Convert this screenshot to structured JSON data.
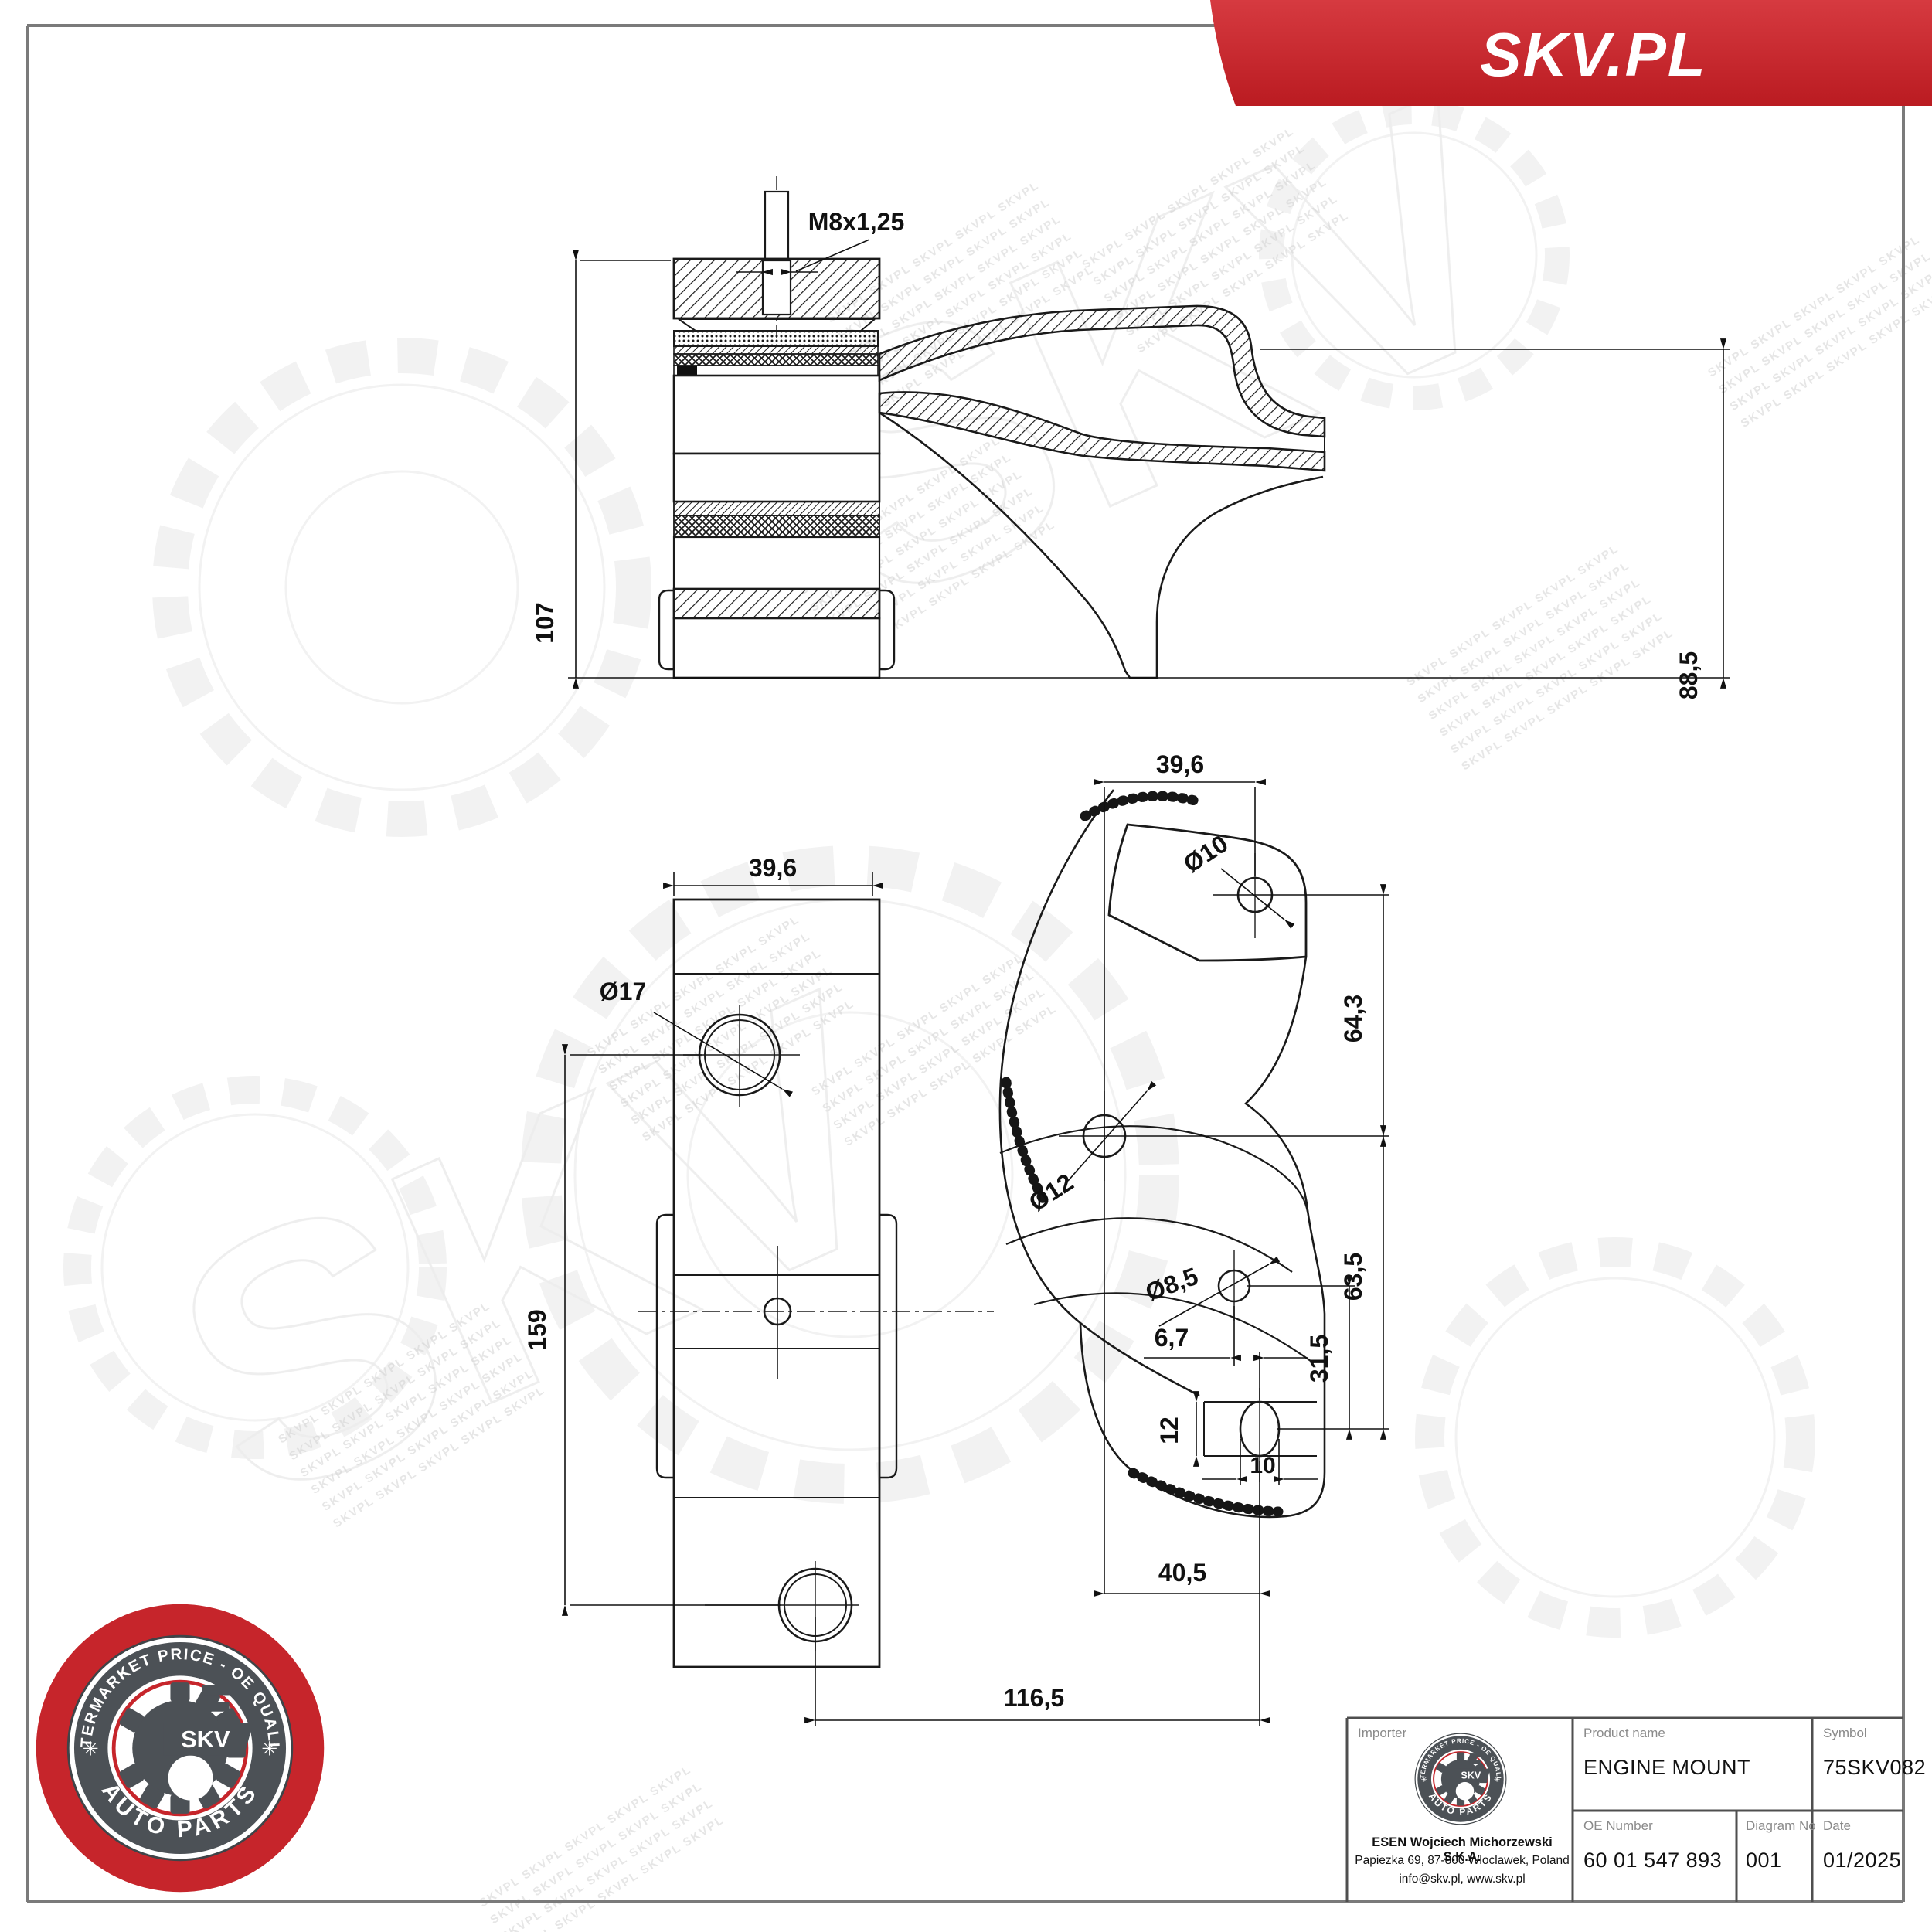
{
  "banner": {
    "brand": "SKV.PL"
  },
  "watermark": {
    "line": "SKVPL SKVPL SKVPL SKVPL SKVPL",
    "big": "SKV"
  },
  "logo": {
    "brand": "SKV",
    "arc_top": "AFTERMARKET PRICE - OE QUALITY",
    "arc_bottom": "AUTO PARTS",
    "star_left": "✳",
    "star_right": "✳",
    "red": "#c6252b",
    "dark": "#4c5156"
  },
  "dims": {
    "m8": "M8x1,25",
    "h107": "107",
    "h885": "88,5",
    "w396_left": "39,6",
    "d17": "Ø17",
    "h159": "159",
    "w1165": "116,5",
    "w396_right": "39,6",
    "d10": "Ø10",
    "h643": "64,3",
    "d12": "Ø12",
    "d85": "Ø8,5",
    "w67": "6,7",
    "h635": "63,5",
    "h315": "31,5",
    "h12": "12",
    "w10": "10",
    "w405": "40,5"
  },
  "title_block": {
    "importer_label": "Importer",
    "importer_name": "ESEN Wojciech Michorzewski S.K.A.",
    "importer_address": "Papiezka 69, 87-800 Wloclawek, Poland",
    "importer_contact": "info@skv.pl, www.skv.pl",
    "product_label": "Product name",
    "product": "ENGINE MOUNT",
    "symbol_label": "Symbol",
    "symbol": "75SKV082",
    "oe_label": "OE Number",
    "oe": "60 01 547 893",
    "diagram_label": "Diagram No",
    "diagram": "001",
    "date_label": "Date",
    "date": "01/2025"
  }
}
